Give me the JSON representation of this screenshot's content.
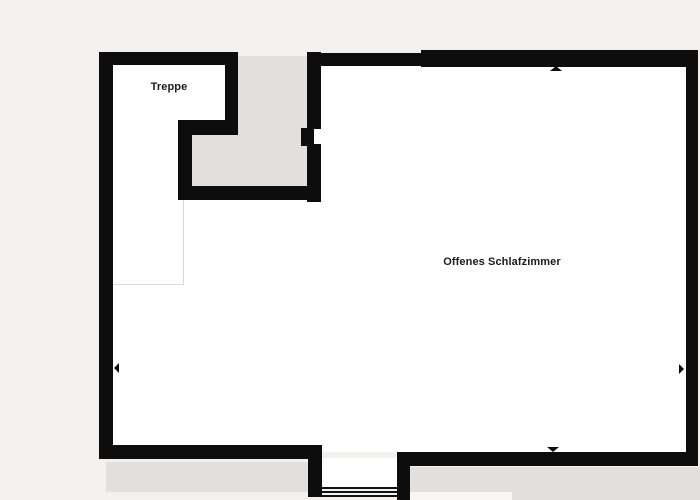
{
  "plan": {
    "title": "floor-plan",
    "rooms": [
      {
        "id": "treppe",
        "label": "Treppe"
      },
      {
        "id": "offenes-schlafzimmer",
        "label": "Offenes Schlafzimmer"
      }
    ],
    "features": {
      "stair_treads_count": 3,
      "door_openings": 1
    },
    "icons": {
      "arrows": [
        "arrow-left-icon",
        "arrow-right-icon",
        "arrow-up-icon",
        "arrow-down-icon"
      ]
    },
    "colors": {
      "background": "#f2f1ef",
      "wall": "#0d0d0d",
      "floor": "#ffffff",
      "stairwell_void": "#e1e0df",
      "outline": "#d8d8d8",
      "label_text": "#1b1b1b"
    }
  }
}
